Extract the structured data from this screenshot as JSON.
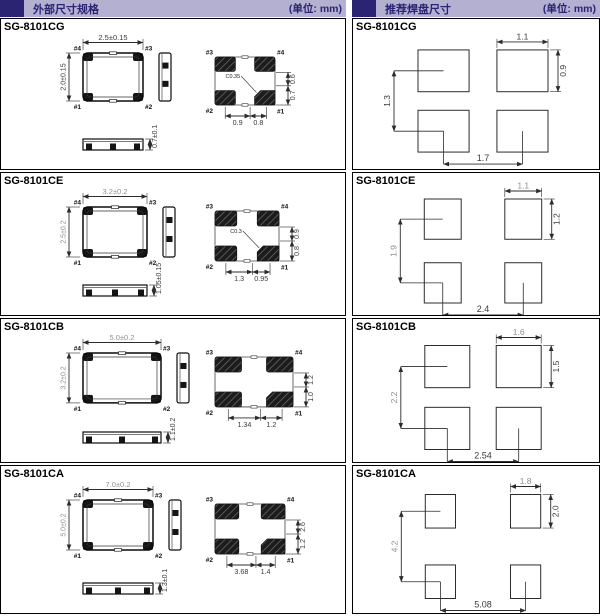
{
  "headers": {
    "left": {
      "title": "外部尺寸规格",
      "unit": "(单位: mm)"
    },
    "right": {
      "title": "推荐焊盘尺寸",
      "unit": "(单位: mm)"
    }
  },
  "colors": {
    "header_bar": "#b4b0d2",
    "header_accent": "#2a2473",
    "header_text": "#2a2473",
    "line": "#2c2c2c",
    "dim_dark": "#3a3a3a",
    "dim_muted": "#8f8f8f",
    "pad_dark": "#1c1c1c"
  },
  "rows": [
    {
      "model": "SG-8101CG",
      "package": {
        "body_mm": {
          "w": 2.5,
          "h": 2.0
        },
        "top_view": {
          "width_label": "2.5±0.15",
          "height_label": "2.0±0.15",
          "pins": {
            "tl": "#4",
            "tr": "#3",
            "bl": "#1",
            "br": "#2"
          }
        },
        "pad_view": {
          "pins": {
            "tl": "#3",
            "tr": "#4",
            "bl": "#2",
            "br": "#1"
          },
          "right_dims": [
            "0.6",
            "0.7"
          ],
          "bottom_dims": [
            "0.9",
            "0.8"
          ],
          "chamfer_label": "C0.35"
        },
        "height_label": "0.7±0.1",
        "dims_muted": false
      },
      "land_pattern": {
        "pad_width": "1.1",
        "pad_height": "0.9",
        "vertical_pitch": "1.3",
        "horizontal_pitch": "1.7",
        "muted": false
      }
    },
    {
      "model": "SG-8101CE",
      "package": {
        "body_mm": {
          "w": 3.2,
          "h": 2.5
        },
        "top_view": {
          "width_label": "3.2±0.2",
          "height_label": "2.5±0.2",
          "pins": {
            "tl": "#4",
            "tr": "#3",
            "bl": "#1",
            "br": "#2"
          }
        },
        "pad_view": {
          "pins": {
            "tl": "#3",
            "tr": "#4",
            "bl": "#2",
            "br": "#1"
          },
          "right_dims": [
            "0.9",
            "0.8"
          ],
          "bottom_dims": [
            "1.3",
            "0.95"
          ],
          "chamfer_label": "C0.3"
        },
        "height_label": "1.05±0.15",
        "dims_muted": true
      },
      "land_pattern": {
        "pad_width": "1.1",
        "pad_height": "1.2",
        "vertical_pitch": "1.9",
        "horizontal_pitch": "2.4",
        "muted": true
      }
    },
    {
      "model": "SG-8101CB",
      "package": {
        "body_mm": {
          "w": 5.0,
          "h": 3.2
        },
        "top_view": {
          "width_label": "5.0±0.2",
          "height_label": "3.2±0.2",
          "pins": {
            "tl": "#4",
            "tr": "#3",
            "bl": "#1",
            "br": "#2"
          }
        },
        "pad_view": {
          "pins": {
            "tl": "#3",
            "tr": "#4",
            "bl": "#2",
            "br": "#1"
          },
          "right_dims": [
            "1.2",
            "1.0"
          ],
          "bottom_dims": [
            "1.34",
            "1.2"
          ],
          "chamfer_label": ""
        },
        "height_label": "1.1±0.2",
        "dims_muted": true
      },
      "land_pattern": {
        "pad_width": "1.6",
        "pad_height": "1.5",
        "vertical_pitch": "2.2",
        "horizontal_pitch": "2.54",
        "muted": true
      }
    },
    {
      "model": "SG-8101CA",
      "package": {
        "body_mm": {
          "w": 7.0,
          "h": 5.0
        },
        "top_view": {
          "width_label": "7.0±0.2",
          "height_label": "5.0±0.2",
          "pins": {
            "tl": "#4",
            "tr": "#3",
            "bl": "#1",
            "br": "#2"
          }
        },
        "pad_view": {
          "pins": {
            "tl": "#3",
            "tr": "#4",
            "bl": "#2",
            "br": "#1"
          },
          "right_dims": [
            "2.6",
            "1.2"
          ],
          "bottom_dims": [
            "3.68",
            "1.4"
          ],
          "chamfer_label": ""
        },
        "height_label": "1.3±0.1",
        "dims_muted": true
      },
      "land_pattern": {
        "pad_width": "1.8",
        "pad_height": "2.0",
        "vertical_pitch": "4.2",
        "horizontal_pitch": "5.08",
        "muted": true
      }
    }
  ]
}
